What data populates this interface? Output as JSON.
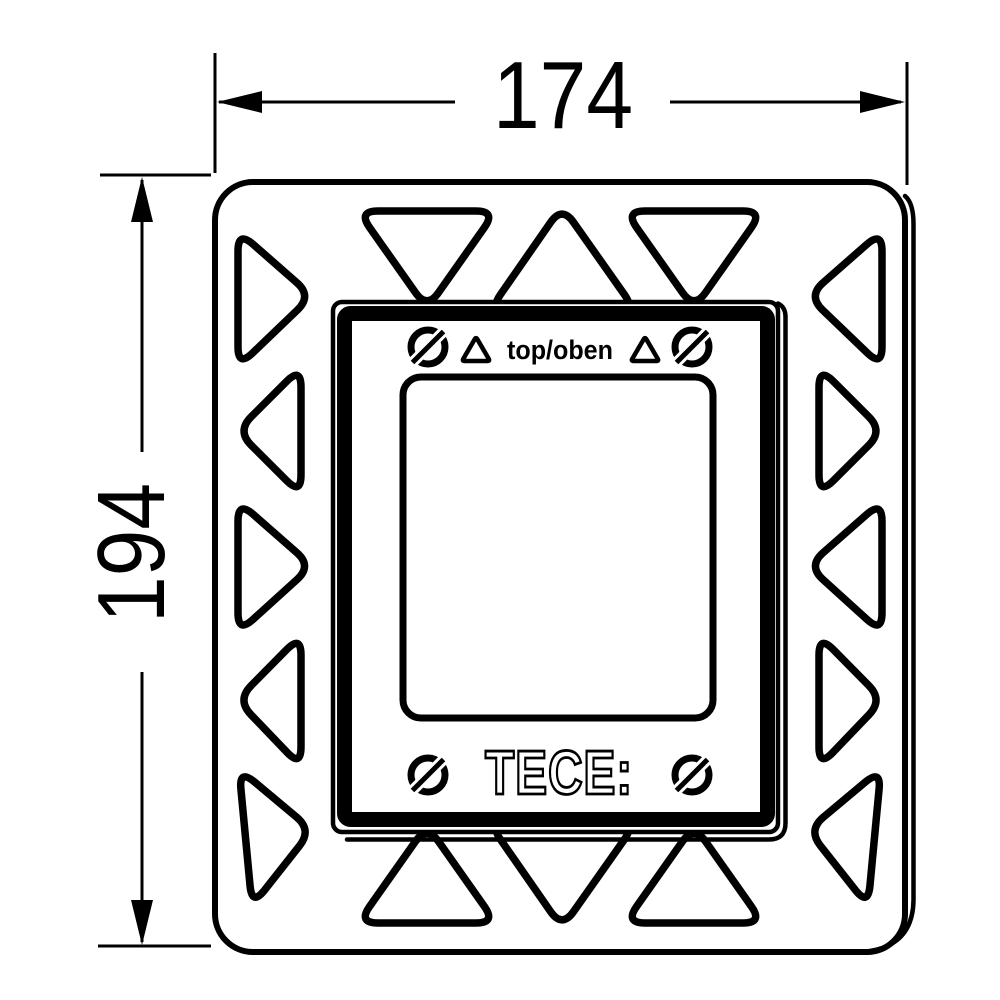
{
  "drawing": {
    "dimension_width": {
      "value": "174"
    },
    "dimension_height": {
      "value": "194"
    },
    "plate": {
      "orientation_label": "top/oben",
      "brand_logo": "TECE:"
    },
    "colors": {
      "line": "#000000",
      "background": "#ffffff"
    }
  }
}
